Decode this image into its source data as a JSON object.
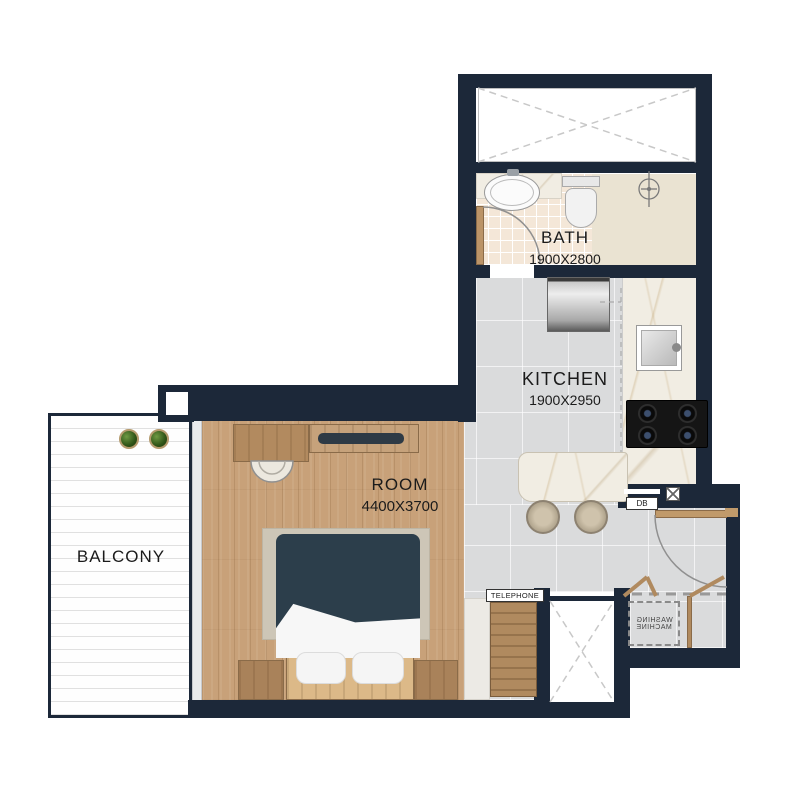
{
  "colors": {
    "wall": "#1c2839",
    "room-floor": "#c8a179",
    "kitchen-floor": "#dadbdc",
    "bath-tile": "#f4e7d8",
    "shower-floor": "#eae3d2",
    "marble": "#f1ede3",
    "wood": "#b28a5f",
    "wood-dark": "#8a6b49",
    "duvet": "#2c3e4b",
    "rug": "#cdc6b7",
    "balcony-line": "#e0e0e0",
    "text": "#1b1b1b"
  },
  "rooms": {
    "bath": {
      "label": "BATH",
      "dimensions": "1900X2800"
    },
    "kitchen": {
      "label": "KITCHEN",
      "dimensions": "1900X2950"
    },
    "room": {
      "label": "ROOM",
      "dimensions": "4400X3700"
    },
    "balcony": {
      "label": "BALCONY"
    }
  },
  "annotations": {
    "telephone": "TELEPHONE",
    "db": "DB",
    "washing_machine": {
      "line1": "WASHING",
      "line2": "MACHINE"
    }
  }
}
